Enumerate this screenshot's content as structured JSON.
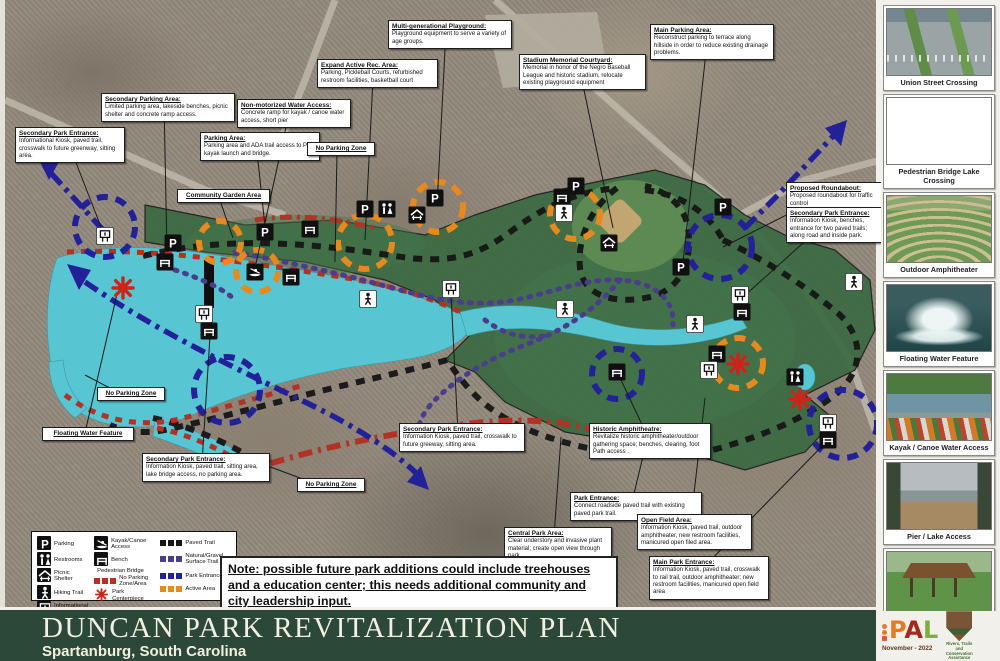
{
  "title_bar": {
    "title": "DUNCAN PARK REVITALIZATION PLAN",
    "subtitle": "Spartanburg, South Carolina"
  },
  "note": {
    "text": "Note:  possible future park additions could include treehouses and a education center; this needs additional community and city leadership input."
  },
  "credits": {
    "date": "November - 2022",
    "pal_letters": [
      {
        "ch": "P",
        "color": "#e07b28"
      },
      {
        "ch": "A",
        "color": "#a3281e"
      },
      {
        "ch": "L",
        "color": "#7fae3f"
      }
    ],
    "nps_caption": "Rivers, Trails and Conservation Assistance"
  },
  "colors": {
    "map_green": "#3a6a42",
    "lake": "#58c5d3",
    "paved_trail": "#161616",
    "natural_gravel_trail": "#4a3d8c",
    "park_entrance": "#23219a",
    "active_area": "#e8891d",
    "no_parking": "#b23325",
    "park_centerpiece": "#cc2418",
    "title_bar_bg": "#2b4839"
  },
  "legend": {
    "columns": [
      [
        {
          "icon": "parking",
          "label": "Parking"
        },
        {
          "icon": "restroom",
          "label": "Restrooms"
        },
        {
          "icon": "picnic",
          "label": "Picnic Shelter"
        },
        {
          "icon": "hiker",
          "label": "Hiking Trail"
        },
        {
          "icon": "kiosk",
          "label": "Informational Kiosk"
        }
      ],
      [
        {
          "icon": "kayak",
          "label": "Kayak/Canoe Access"
        },
        {
          "icon": "bench",
          "label": "Bench"
        },
        {
          "icon": "bar",
          "label": "Pedestrian Bridge"
        },
        {
          "icon": "sw-red",
          "label": "No Parking Zone/Area"
        },
        {
          "icon": "aster",
          "label": "Park Centerpiece"
        }
      ],
      [
        {
          "icon": "sw-black",
          "label": "Paved Trail"
        },
        {
          "icon": "sw-purple",
          "label": "Natural/Gravel Surface Trail"
        },
        {
          "icon": "sw-blue",
          "label": "Park Entrance"
        },
        {
          "icon": "sw-orange",
          "label": "Active Area"
        }
      ]
    ]
  },
  "callouts": [
    {
      "id": "secondary-parking-area",
      "x": 96,
      "y": 93,
      "w": 126,
      "tx": 162,
      "ty": 252,
      "title": "Secondary Parking Area:",
      "body": "Limited parking area, lakeside benches, picnic shelter and concrete ramp access."
    },
    {
      "id": "secondary-park-entrance-nw",
      "x": 10,
      "y": 127,
      "w": 102,
      "tx": 98,
      "ty": 232,
      "title": "Secondary Park Entrance:",
      "body": "Informational Kiosk, paved trail, crosswalk to future greenway, sitting area."
    },
    {
      "id": "non-motorized-water-access",
      "x": 232,
      "y": 99,
      "w": 106,
      "tx": 250,
      "ty": 268,
      "title": "Non-motorized Water Access:",
      "body": "Concrete ramp for kayak / canoe water access, short pier"
    },
    {
      "id": "parking-area",
      "x": 195,
      "y": 132,
      "w": 112,
      "tx": 261,
      "ty": 236,
      "title": "Parking Area:",
      "body": "Parking area and ADA trail access to Pier, kayak launch and bridge."
    },
    {
      "id": "no-parking-zone-top",
      "x": 302,
      "y": 142,
      "w": 60,
      "tx": 330,
      "ty": 262,
      "title": "No Parking Zone",
      "body": ""
    },
    {
      "id": "expand-active-rec-area",
      "x": 312,
      "y": 59,
      "w": 113,
      "tx": 360,
      "ty": 240,
      "title": "Expand Active Rec. Area:",
      "body": "Parking, Pickleball Courts, refurbished restroom facilities, basketball court"
    },
    {
      "id": "multi-generational-playground",
      "x": 383,
      "y": 20,
      "w": 116,
      "tx": 432,
      "ty": 206,
      "title": "Multi-generational Playground:",
      "body": "Playground equipment to serve a variety of age groups."
    },
    {
      "id": "stadium-memorial-courtyard",
      "x": 514,
      "y": 54,
      "w": 119,
      "tx": 608,
      "ty": 228,
      "title": "Stadium Memorial Courtyard:",
      "body": "Memorial in honor of the Negro Baseball League and historic stadium, relocate existing playground equipment"
    },
    {
      "id": "main-parking-area",
      "x": 645,
      "y": 24,
      "w": 116,
      "tx": 678,
      "ty": 262,
      "title": "Main Parking Area:",
      "body": "Reconstruct parking to terrace along hillside in order to reduce existing drainage problems."
    },
    {
      "id": "community-garden-area",
      "x": 172,
      "y": 189,
      "w": 85,
      "tx": 228,
      "ty": 238,
      "title": "Community Garden Area",
      "body": ""
    },
    {
      "id": "proposed-roundabout",
      "x": 781,
      "y": 182,
      "w": 92,
      "tx": 718,
      "ty": 247,
      "title": "Proposed Roundabout:",
      "body": "Proposed roundabout for traffic control"
    },
    {
      "id": "secondary-park-entrance-e",
      "x": 781,
      "y": 207,
      "w": 92,
      "tx": 737,
      "ty": 298,
      "title": "Secondary Park Entrance:",
      "body": "Information Kiosk, benches, entrance for two paved trails; along road and inside park."
    },
    {
      "id": "no-parking-zone-left",
      "x": 92,
      "y": 387,
      "w": 60,
      "tx": 80,
      "ty": 375,
      "title": "No Parking Zone",
      "body": ""
    },
    {
      "id": "floating-water-feature",
      "x": 37,
      "y": 427,
      "w": 84,
      "tx": 112,
      "ty": 294,
      "title": "Floating Water Feature",
      "body": ""
    },
    {
      "id": "secondary-park-entrance-s",
      "x": 137,
      "y": 453,
      "w": 120,
      "tx": 205,
      "ty": 336,
      "title": "Secondary Park Entrance:",
      "body": "Information Kiosk, paved trail, sitting area, lake bridge access, no parking area."
    },
    {
      "id": "no-parking-zone-right",
      "x": 292,
      "y": 478,
      "w": 60,
      "tx": 252,
      "ty": 462,
      "title": "No Parking Zone",
      "body": ""
    },
    {
      "id": "secondary-park-entrance-mid",
      "x": 394,
      "y": 423,
      "w": 118,
      "tx": 446,
      "ty": 294,
      "title": "Secondary Park Entrance:",
      "body": "Information Kiosk, paved trail, crosswalk to future greeway, sitting area."
    },
    {
      "id": "historic-amphitheatre",
      "x": 584,
      "y": 423,
      "w": 114,
      "tx": 616,
      "ty": 380,
      "title": "Historic Amphitheatre:",
      "body": "Revitalize historic amphitheater/outdoor gathering space; benches, clearing, foot Path access ."
    },
    {
      "id": "park-entrance",
      "x": 565,
      "y": 492,
      "w": 124,
      "tx": 640,
      "ty": 448,
      "title": "Park Entrance:",
      "body": "Connect roadside paved trail with existing paved park trail."
    },
    {
      "id": "central-park-area",
      "x": 499,
      "y": 527,
      "w": 100,
      "tx": 556,
      "ty": 437,
      "title": "Central Park Area:",
      "body": "Clear understory and invasive plant material; create open view through park."
    },
    {
      "id": "open-field-area",
      "x": 632,
      "y": 514,
      "w": 107,
      "tx": 700,
      "ty": 398,
      "title": "Open Field Area:",
      "body": "Information Kiosk, paved trail, outdoor amphitheater, new restroom facilities, manicured open filed area."
    },
    {
      "id": "main-park-entrance",
      "x": 644,
      "y": 556,
      "w": 112,
      "tx": 826,
      "ty": 437,
      "title": "Main Park Entrance:",
      "body": "Information Kiosk, paved trail, crosswalk to rail trail, outdoor amphitheater; new restroom facilities, manicured open field area"
    }
  ],
  "map": {
    "markers": [
      {
        "t": "kiosk",
        "x": 100,
        "y": 236
      },
      {
        "t": "bench",
        "x": 160,
        "y": 262
      },
      {
        "t": "parking",
        "x": 168,
        "y": 243
      },
      {
        "t": "parking",
        "x": 260,
        "y": 232
      },
      {
        "t": "bench",
        "x": 305,
        "y": 229
      },
      {
        "t": "kayak",
        "x": 250,
        "y": 272
      },
      {
        "t": "bench",
        "x": 286,
        "y": 277
      },
      {
        "t": "parking",
        "x": 360,
        "y": 209
      },
      {
        "t": "restroom",
        "x": 382,
        "y": 209
      },
      {
        "t": "parking",
        "x": 430,
        "y": 198
      },
      {
        "t": "picnic",
        "x": 412,
        "y": 215
      },
      {
        "t": "hiker",
        "x": 363,
        "y": 299
      },
      {
        "t": "kiosk",
        "x": 446,
        "y": 289
      },
      {
        "t": "kiosk",
        "x": 199,
        "y": 314
      },
      {
        "t": "bench",
        "x": 204,
        "y": 331
      },
      {
        "t": "parking",
        "x": 571,
        "y": 186
      },
      {
        "t": "bench",
        "x": 557,
        "y": 197
      },
      {
        "t": "hiker",
        "x": 559,
        "y": 213
      },
      {
        "t": "picnic",
        "x": 604,
        "y": 243
      },
      {
        "t": "parking",
        "x": 676,
        "y": 267
      },
      {
        "t": "parking",
        "x": 718,
        "y": 207
      },
      {
        "t": "kiosk",
        "x": 735,
        "y": 295
      },
      {
        "t": "bench",
        "x": 737,
        "y": 312
      },
      {
        "t": "hiker",
        "x": 690,
        "y": 324
      },
      {
        "t": "hiker",
        "x": 849,
        "y": 282
      },
      {
        "t": "bench",
        "x": 612,
        "y": 372
      },
      {
        "t": "bench",
        "x": 712,
        "y": 354
      },
      {
        "t": "kiosk",
        "x": 704,
        "y": 370
      },
      {
        "t": "restroom",
        "x": 790,
        "y": 377
      },
      {
        "t": "kiosk",
        "x": 823,
        "y": 423
      },
      {
        "t": "bench",
        "x": 823,
        "y": 440
      },
      {
        "t": "hiker",
        "x": 560,
        "y": 309
      }
    ],
    "centerpieces": [
      {
        "x": 118,
        "y": 288
      },
      {
        "x": 733,
        "y": 364
      },
      {
        "x": 795,
        "y": 399
      }
    ],
    "entrance_circles": [
      {
        "x": 100,
        "y": 227,
        "r": 30
      },
      {
        "x": 222,
        "y": 390,
        "r": 33
      },
      {
        "x": 715,
        "y": 247,
        "r": 32
      },
      {
        "x": 612,
        "y": 374,
        "r": 25
      },
      {
        "x": 838,
        "y": 424,
        "r": 34
      }
    ],
    "active_circles": [
      {
        "x": 215,
        "y": 242,
        "r": 21
      },
      {
        "x": 252,
        "y": 271,
        "r": 21
      },
      {
        "x": 360,
        "y": 242,
        "r": 27
      },
      {
        "x": 433,
        "y": 207,
        "r": 25
      },
      {
        "x": 570,
        "y": 214,
        "r": 25
      },
      {
        "x": 733,
        "y": 363,
        "r": 25
      }
    ]
  },
  "sidebar": {
    "photos": [
      {
        "caption": "Union Street Crossing",
        "kind": "street"
      },
      {
        "caption": "Pedestrian Bridge Lake Crossing",
        "kind": "bridge"
      },
      {
        "caption": "Outdoor Amphitheater",
        "kind": "amph"
      },
      {
        "caption": "Floating Water Feature",
        "kind": "fountain"
      },
      {
        "caption": "Kayak / Canoe Water Access",
        "kind": "kayak"
      },
      {
        "caption": "Pier / Lake Access",
        "kind": "pier"
      },
      {
        "caption": "Picnic Shelter (TYP)",
        "kind": "shelter"
      }
    ]
  }
}
